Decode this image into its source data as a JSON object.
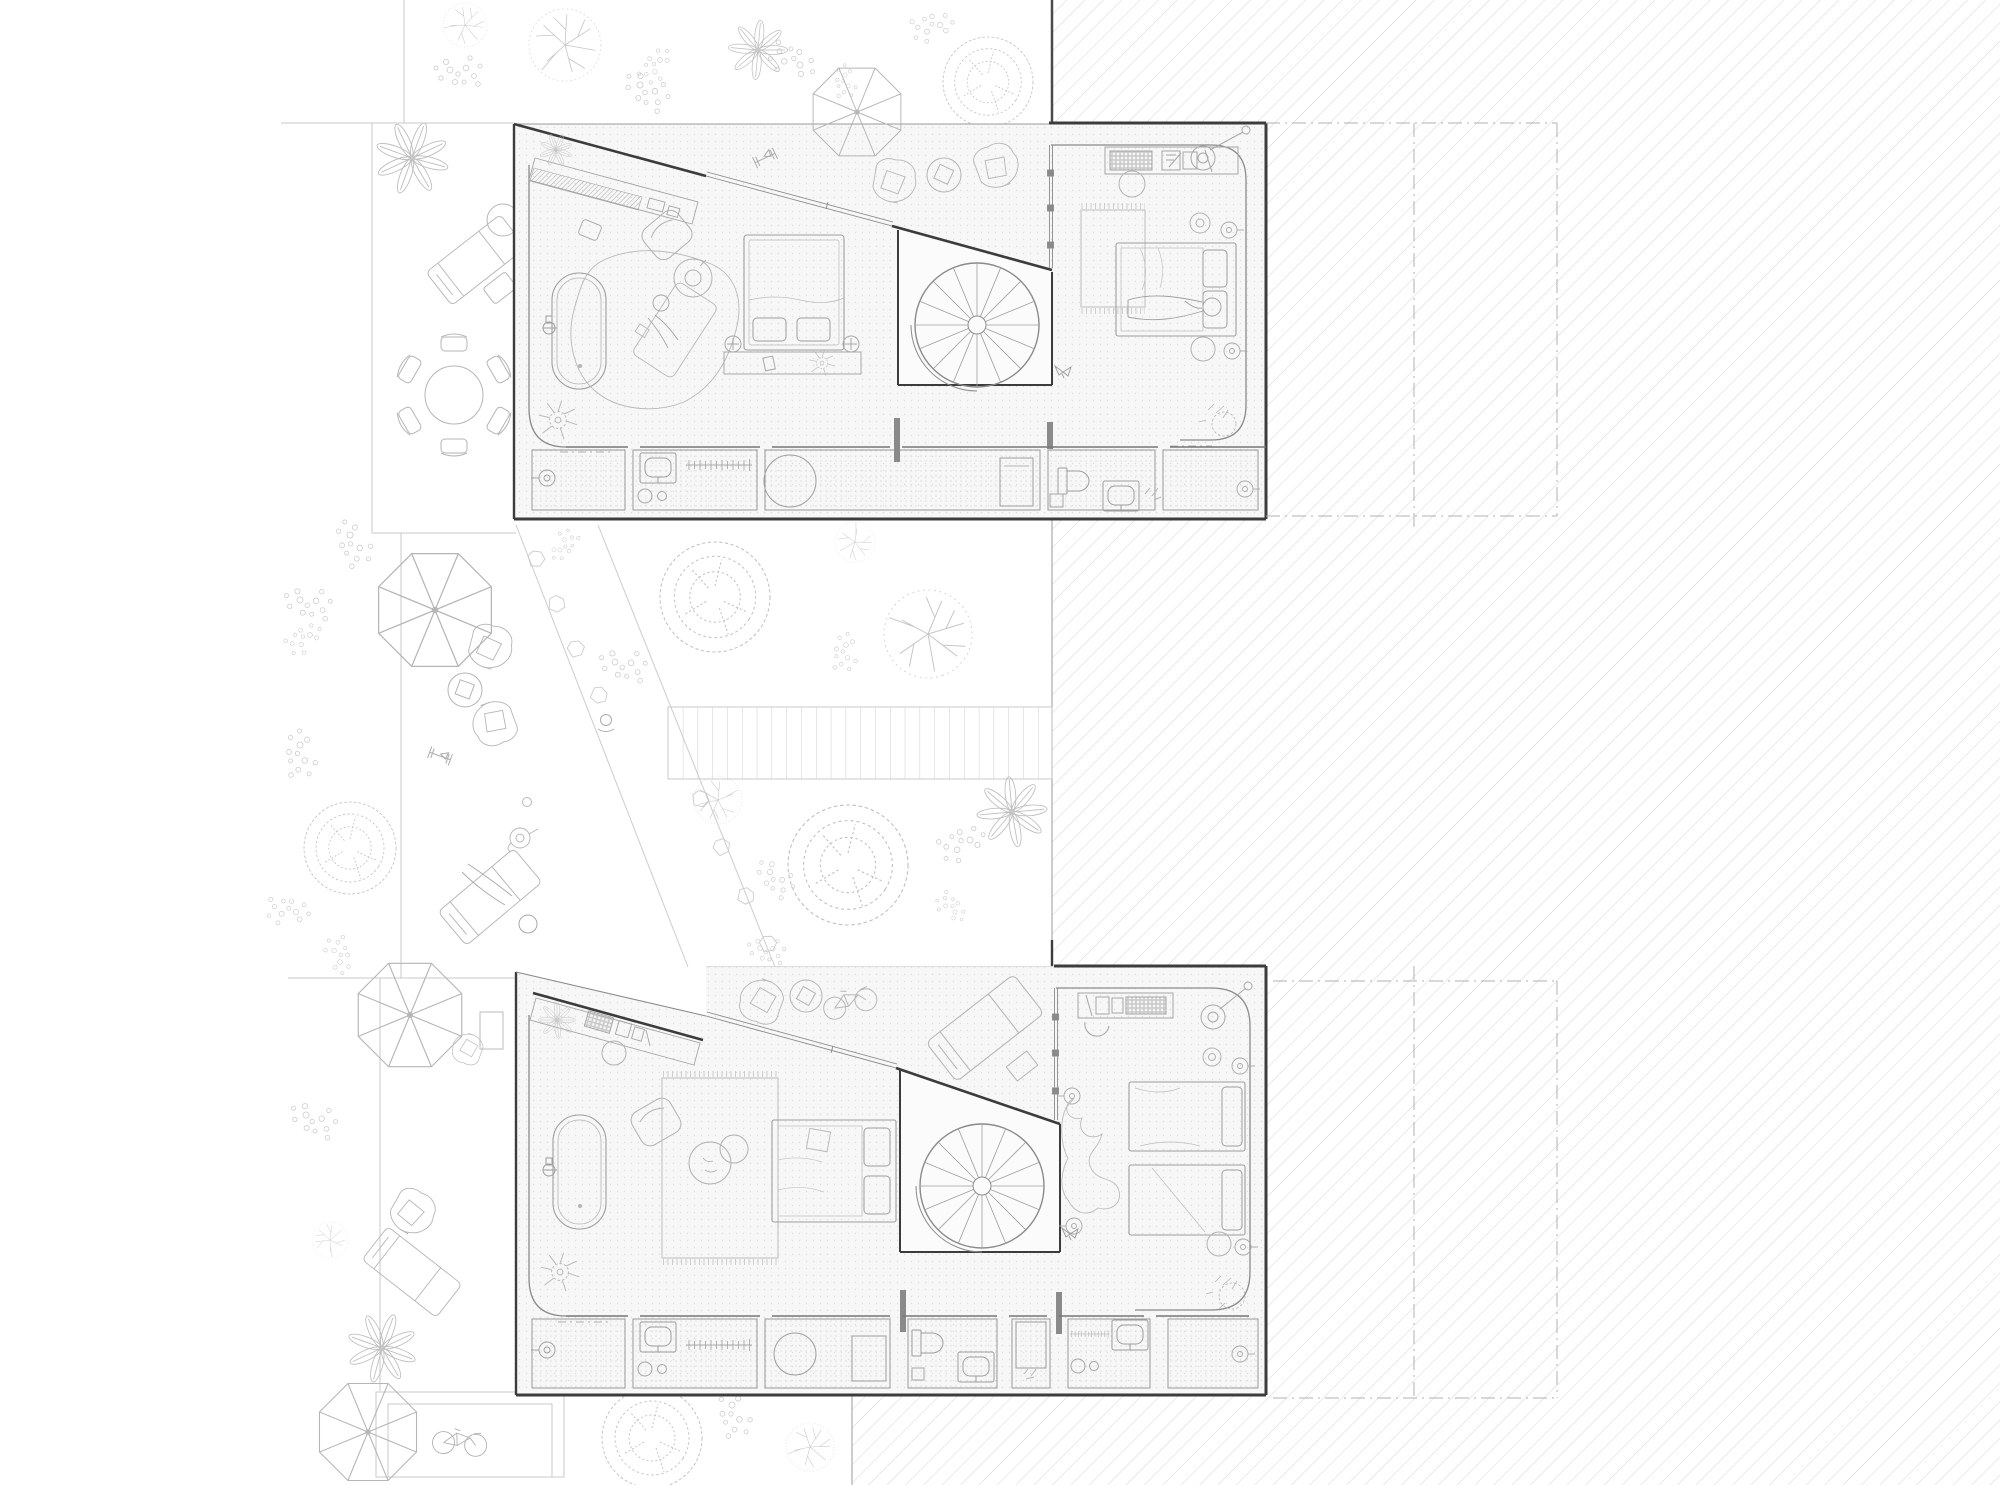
{
  "title": "",
  "drawing": {
    "kind": "architectural plan drawing, two stacked dwelling floor plans with garden and hatched context",
    "colors": {
      "background": "#ffffff",
      "wall": "#3c3c3c",
      "inner_wall": "#8a8a8a",
      "furniture": "#a9a9a9",
      "garden_line": "#c9c9c9",
      "hatch_line": "#d5d5d5",
      "floor_fill": "#f7f7f7",
      "floor_dot": "#dcdcdc",
      "service_room_fill": "#efefef",
      "service_room_dot": "#d6d6d6",
      "stair_room_fill": "#fbfbfb",
      "boundary_dash": "#b0b0b0"
    },
    "regions": {
      "upper_plan": "upper unit floor plan with terrace, spiral stair, bedroom and service strip",
      "lower_plan": "lower unit floor plan with terrace, spiral stair, twin-bed room and service strip",
      "garden": "landscaped garden with trees, umbrellas, loungers and stepping-stone path",
      "context": "diagonally hatched neighbouring footprint with dash-dot setback boxes"
    }
  }
}
